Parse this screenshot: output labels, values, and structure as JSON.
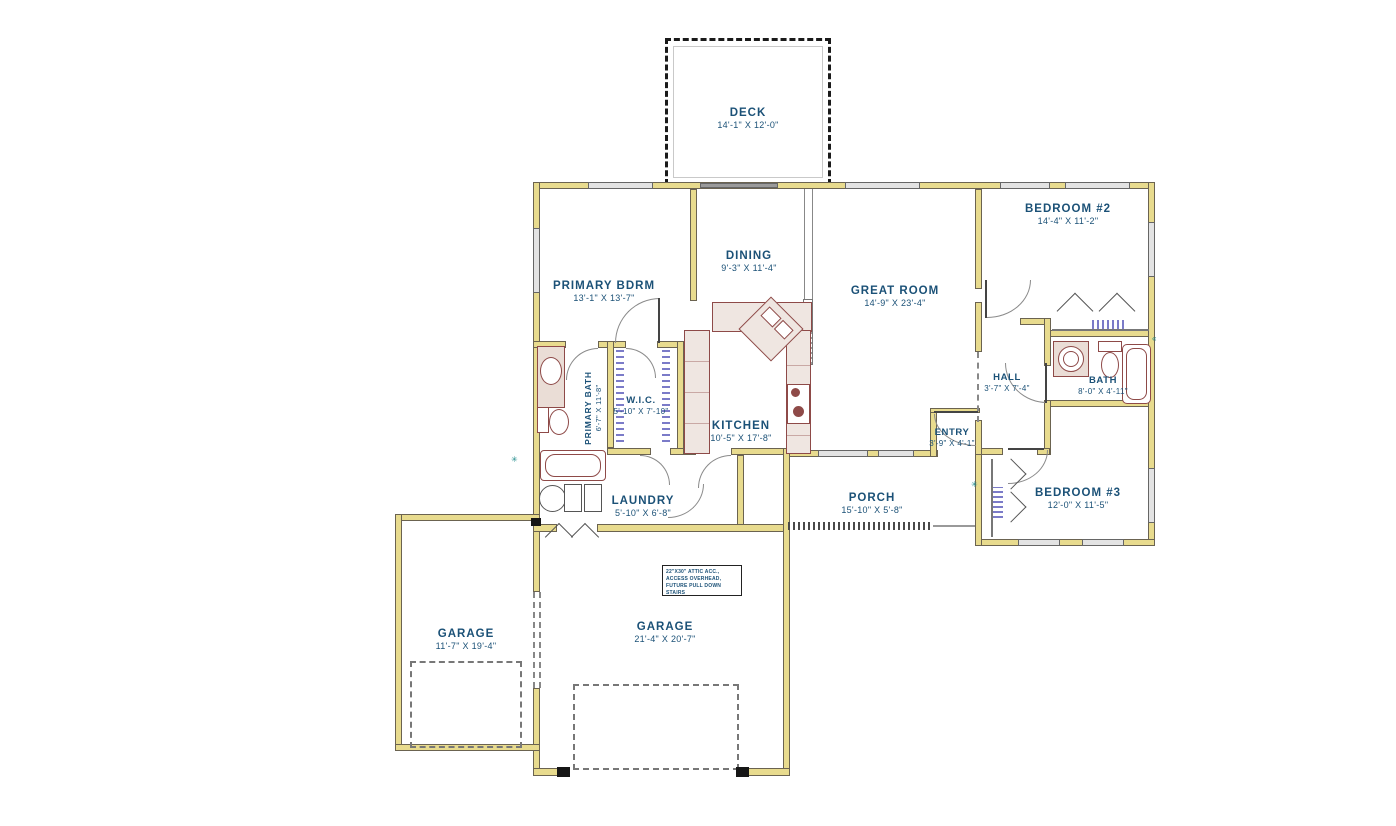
{
  "plan": {
    "rooms": {
      "deck": {
        "name": "DECK",
        "dims": "14'-1\" X 12'-0\""
      },
      "primary_bdrm": {
        "name": "PRIMARY BDRM",
        "dims": "13'-1\" X 13'-7\""
      },
      "dining": {
        "name": "DINING",
        "dims": "9'-3\" X 11'-4\""
      },
      "great_room": {
        "name": "GREAT ROOM",
        "dims": "14'-9\" X 23'-4\""
      },
      "bedroom2": {
        "name": "BEDROOM #2",
        "dims": "14'-4\" X 11'-2\""
      },
      "wic": {
        "name": "W.I.C.",
        "dims": "5'-10\" X 7'-10\""
      },
      "kitchen": {
        "name": "KITCHEN",
        "dims": "10'-5\" X 17'-8\""
      },
      "primary_bath": {
        "name": "PRIMARY BATH",
        "dims": "6'-7\" X 11'-8\""
      },
      "hall": {
        "name": "HALL",
        "dims": "3'-7\" X 7'-4\""
      },
      "bath": {
        "name": "BATH",
        "dims": "8'-0\" X 4'-11\""
      },
      "entry": {
        "name": "ENTRY",
        "dims": "3'-9\" X 4'-1\""
      },
      "laundry": {
        "name": "LAUNDRY",
        "dims": "5'-10\" X 6'-8\""
      },
      "porch": {
        "name": "PORCH",
        "dims": "15'-10\" X 5'-8\""
      },
      "bedroom3": {
        "name": "BEDROOM #3",
        "dims": "12'-0\" X 11'-5\""
      },
      "garage_left": {
        "name": "GARAGE",
        "dims": "11'-7\" X 19'-4\""
      },
      "garage_right": {
        "name": "GARAGE",
        "dims": "21'-4\" X 20'-7\""
      }
    },
    "note": {
      "line1": "22\"X30\" ATTIC ACC.,",
      "line2": "ACCESS OVERHEAD,",
      "line3": "FUTURE PULL DOWN STAIRS"
    },
    "symbols": {
      "s1": "✳",
      "s2": "✳",
      "s3": "«"
    },
    "colors": {
      "wall": "#E8DB8E",
      "label": "#1B5177",
      "fixture": "#8E4A48",
      "closet_marks": "#7B7BC8",
      "window": "#8A8A8A"
    }
  }
}
